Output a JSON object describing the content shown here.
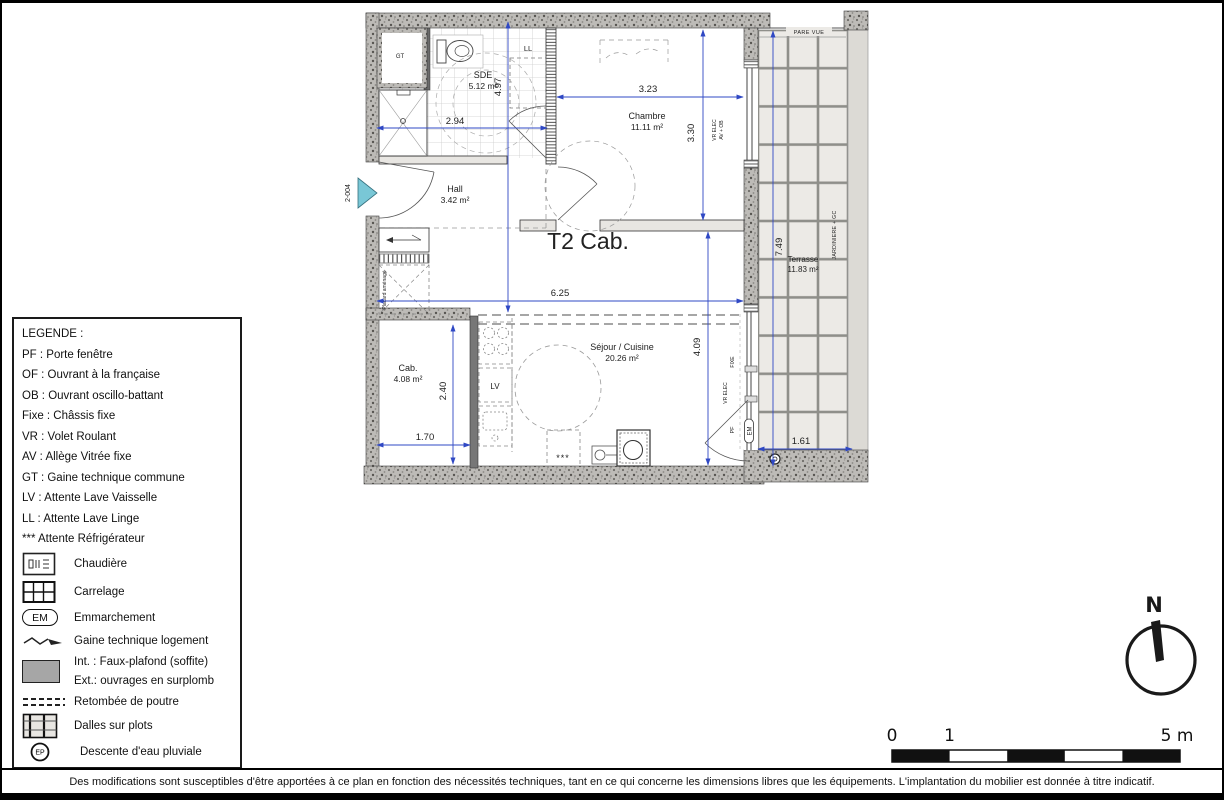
{
  "plan": {
    "title": "T2 Cab.",
    "unit": "2-004",
    "rooms": [
      {
        "name": "SDE",
        "area": "5.12 m²"
      },
      {
        "name": "Chambre",
        "area": "11.11 m²"
      },
      {
        "name": "Hall",
        "area": "3.42 m²"
      },
      {
        "name": "Cab.",
        "area": "4.08 m²"
      },
      {
        "name": "Séjour / Cuisine",
        "area": "20.26 m²"
      },
      {
        "name": "Terrasse",
        "area": "11.83 m²"
      }
    ],
    "dims": {
      "sde_w": "2.94",
      "sde_h": "4.97",
      "ch_w": "3.23",
      "ch_h": "3.30",
      "sej_w": "6.25",
      "sej_h": "4.09",
      "cab_w": "1.70",
      "cab_h": "2.40",
      "ter_h": "7.49",
      "ter_w": "1.61"
    },
    "annotations": {
      "gt": "GT",
      "ll": "LL",
      "lv": "LV",
      "fridge": "***",
      "pare_vue": "PARE VUE",
      "vr_elec": "VR ELEC",
      "av_ob": "AV + OB",
      "fixe": "FIXE",
      "vr_elec2": "VR ELEC",
      "pf": "PF",
      "em": "EM",
      "placard": "Placard aménagé",
      "jardiniere": "JARDINIERE + GC"
    }
  },
  "legend": {
    "title": "LEGENDE :",
    "items": [
      "PF : Porte fenêtre",
      "OF : Ouvrant à la française",
      "OB : Ouvrant oscillo-battant",
      "Fixe : Châssis fixe",
      "VR : Volet Roulant",
      "AV : Allège Vitrée fixe",
      "GT : Gaine technique commune",
      "LV : Attente Lave Vaisselle",
      "LL : Attente Lave Linge",
      "*** Attente Réfrigérateur"
    ],
    "symbols": [
      {
        "label": "Chaudière"
      },
      {
        "label": "Carrelage"
      },
      {
        "badge": "EM",
        "label": "Emmarchement"
      },
      {
        "label": "Gaine technique logement"
      },
      {
        "label1": "Int. : Faux-plafond (soffite)",
        "label2": "Ext.: ouvrages en surplomb"
      },
      {
        "label": "Retombée de poutre"
      },
      {
        "label": "Dalles sur plots"
      },
      {
        "badge": "EP",
        "label": "Descente d'eau pluviale"
      }
    ]
  },
  "compass": {
    "north": "N"
  },
  "scale": {
    "t0": "0",
    "t1": "1",
    "t5": "5 m"
  },
  "footer": {
    "disclaimer": "Des modifications sont susceptibles d'être apportées à ce plan en fonction des nécessités techniques, tant en ce qui concerne les dimensions libres que les équipements. L'implantation du mobilier est donnée à titre indicatif."
  }
}
